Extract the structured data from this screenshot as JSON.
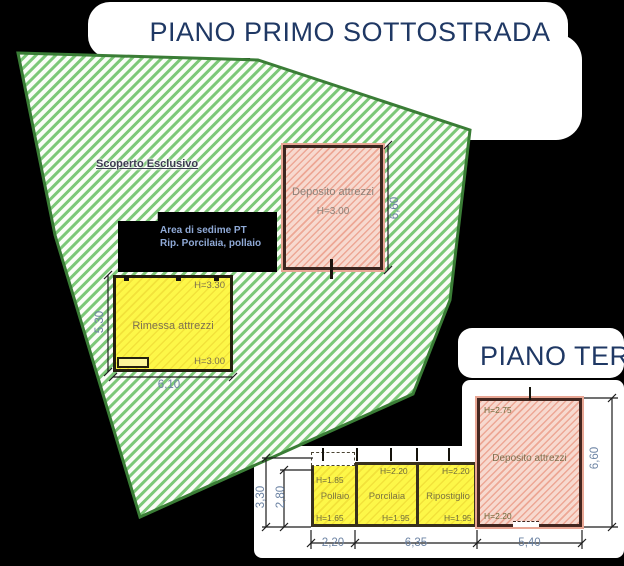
{
  "titles": {
    "site": "PIANO PRIMO SOTTOSTRADA",
    "ground": "PIANO TERR"
  },
  "site_plan": {
    "lot_label": "Scoperto Esclusivo",
    "footprint_line1": "Area di sedime PT",
    "footprint_line2": "Rip. Porcilaia, pollaio",
    "deposito": {
      "name": "Deposito attrezzi",
      "height": "H=3.00",
      "dim_height_right": "6,60"
    },
    "rimessa": {
      "name": "Rimessa attrezzi",
      "height_top": "H=3.30",
      "height_bottom": "H=3.00",
      "dim_width_bottom": "6,10",
      "dim_height_left": "5,30"
    }
  },
  "ground_plan": {
    "rooms": [
      {
        "name": "Pollaio",
        "h_top": "H=1.85",
        "h_bottom": "H=1.65"
      },
      {
        "name": "Porcilaia",
        "h_top": "H=2.20",
        "h_bottom": "H=1.95"
      },
      {
        "name": "Ripostiglio",
        "h_top": "H=2.20",
        "h_bottom": "H=1.95"
      },
      {
        "name": "Deposito attrezzi",
        "h_top": "H=2.75",
        "h_bottom": "H=2.20"
      }
    ],
    "dims": {
      "bottom_segments": [
        "2,20",
        "6,35",
        "5,40"
      ],
      "left_outer": "3,30",
      "left_inner": "2,80",
      "right": "6,60"
    }
  },
  "colors": {
    "title_text": "#1f3864",
    "lot_hatch": "#7cc878",
    "lot_border": "#3a7d36",
    "building_yellow": "#fdf748",
    "building_pink": "#f7d9cf",
    "dim_text": "#6d84a4",
    "room_label": "#7c7440"
  }
}
